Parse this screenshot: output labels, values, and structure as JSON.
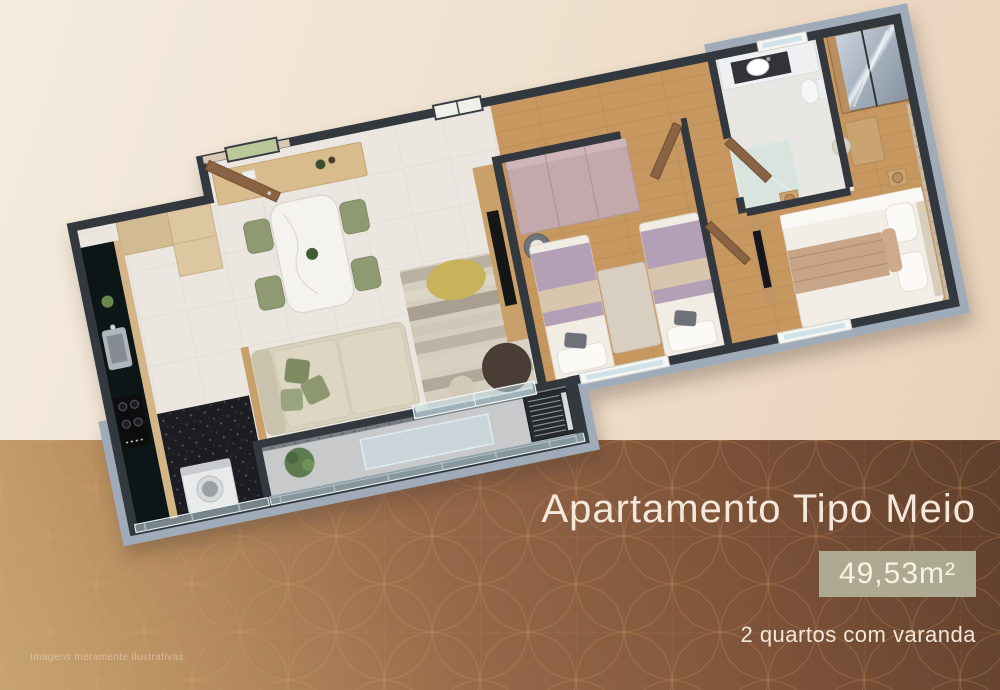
{
  "slide": {
    "title": "Apartamento Tipo Meio",
    "area_badge": "49,53m²",
    "subtitle": "2 quartos com varanda",
    "disclaimer": "Imagens meramente ilustrativas"
  },
  "palette": {
    "background_top": "#f0e1d0",
    "background_band_dark": "#5e3e2c",
    "background_band_light": "#c7a471",
    "pattern_line": "#e8a26a",
    "badge_background": "#b2b199",
    "caption_text": "#f5e8db",
    "wall_cap": "#33383e",
    "exterior_wall": "#9fabb9"
  },
  "floorplan": {
    "type": "3d-isometric-apartment-render",
    "rooms": [
      "kitchen",
      "living-dining",
      "balcony",
      "twin-bedroom",
      "bathroom",
      "master-bedroom",
      "service-area"
    ]
  }
}
